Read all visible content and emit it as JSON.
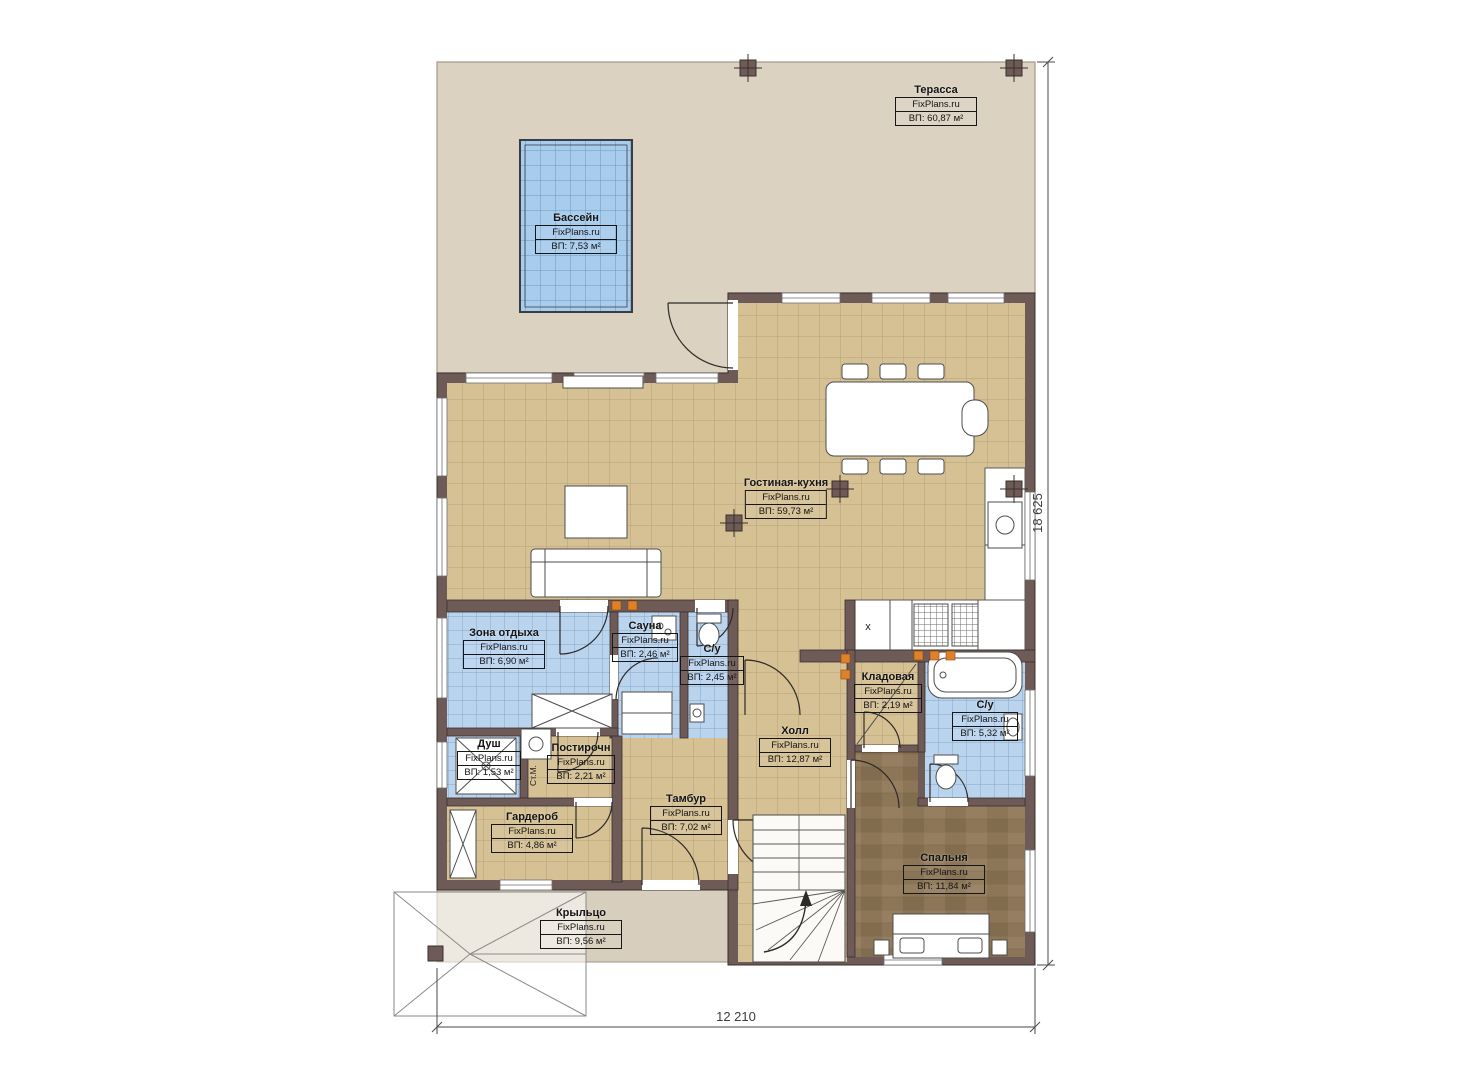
{
  "plan": {
    "dimensions": {
      "width_label": "12 210",
      "height_label": "18 625"
    },
    "rooms": [
      {
        "id": "terrace",
        "name": "Терасса",
        "brand": "FixPlans.ru",
        "area": "ВП: 60,87 м²"
      },
      {
        "id": "pool",
        "name": "Бассейн",
        "brand": "FixPlans.ru",
        "area": "ВП: 7,53 м²"
      },
      {
        "id": "living",
        "name": "Гостиная-кухня",
        "brand": "FixPlans.ru",
        "area": "ВП: 59,73 м²"
      },
      {
        "id": "lounge",
        "name": "Зона отдыха",
        "brand": "FixPlans.ru",
        "area": "ВП: 6,90 м²"
      },
      {
        "id": "sauna",
        "name": "Сауна",
        "brand": "FixPlans.ru",
        "area": "ВП: 2,46 м²"
      },
      {
        "id": "wc1",
        "name": "С/у",
        "brand": "FixPlans.ru",
        "area": "ВП: 2,45 м²"
      },
      {
        "id": "shower",
        "name": "Душ",
        "brand": "FixPlans.ru",
        "area": "ВП: 1,53 м²"
      },
      {
        "id": "laundry",
        "name": "Постирочн",
        "brand": "FixPlans.ru",
        "area": "ВП: 2,21 м²"
      },
      {
        "id": "wardrobe",
        "name": "Гардероб",
        "brand": "FixPlans.ru",
        "area": "ВП: 4,86 м²"
      },
      {
        "id": "vestibule",
        "name": "Тамбур",
        "brand": "FixPlans.ru",
        "area": "ВП: 7,02 м²"
      },
      {
        "id": "hall",
        "name": "Холл",
        "brand": "FixPlans.ru",
        "area": "ВП: 12,87 м²"
      },
      {
        "id": "storage",
        "name": "Кладовая",
        "brand": "FixPlans.ru",
        "area": "ВП: 2,19 м²"
      },
      {
        "id": "wc2",
        "name": "С/у",
        "brand": "FixPlans.ru",
        "area": "ВП: 5,32 м²"
      },
      {
        "id": "bedroom",
        "name": "Спальня",
        "brand": "FixPlans.ru",
        "area": "ВП: 11,84 м²"
      },
      {
        "id": "porch",
        "name": "Крыльцо",
        "brand": "FixPlans.ru",
        "area": "ВП: 9,56 м²"
      }
    ],
    "annotations": {
      "washer": "Ст.М.",
      "sink_cross": "х"
    },
    "colors": {
      "wall": "#6e5a57",
      "terrace": "#dbd2c2",
      "floor_tan": "#d6c194",
      "tile_blue": "#bad4ee",
      "pool_blue": "#a8cdec",
      "wood": "#8d7657",
      "outlet": "#e0812a"
    }
  }
}
